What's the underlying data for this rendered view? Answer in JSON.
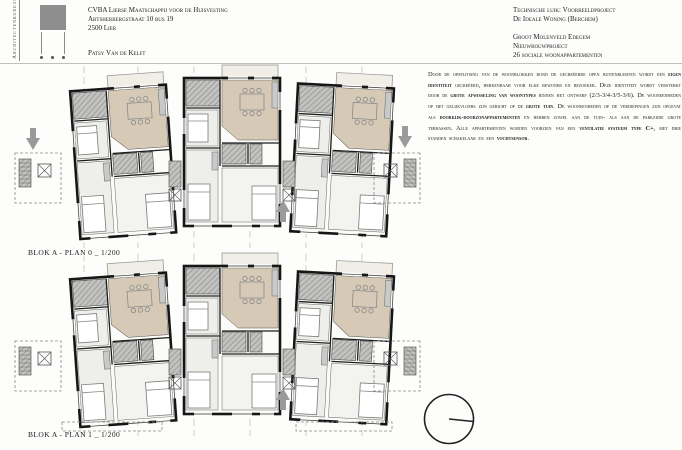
{
  "header": {
    "studio_vertical_label": "Architectenbureau",
    "client": {
      "line1": "CVBA Lierse Maatschappij voor de Huisvesting",
      "line2": "Abtsherbergstraat 10 bus 19",
      "line3": "2500 Lier",
      "contact": "Patsy Van de Kelft"
    },
    "project": {
      "line1": "Technische luik: Voorbeeldproject",
      "line2": "De Ideale Woning (Berchem)",
      "line3": "Groot Molenveld Edegem",
      "line4": "Nieuwbouwproject",
      "line5": "26 sociale woonappartementen"
    }
  },
  "description": {
    "segments": [
      {
        "t": "Door de opsplitsing van de woonblokken rond de gecreëerde open buitenruimten wordt een ",
        "b": false
      },
      {
        "t": "eigen identiteit",
        "b": true
      },
      {
        "t": " gecreëerd, herkenbaar voor elke bewoner en bezoeker. Deze identiteit wordt versterkt door de ",
        "b": false
      },
      {
        "t": "grote afwisseling van woontypes",
        "b": true
      },
      {
        "t": " binnen het ontwerp (2/3-3/4-3/5-3/6). De wooneenheden op het gelijkvloers zijn gericht op de ",
        "b": false
      },
      {
        "t": "grote tuin",
        "b": true
      },
      {
        "t": ". De wooneenheden op de verdiepingen zijn opgevat als ",
        "b": false
      },
      {
        "t": "doorkijk-doorzonappartementen",
        "b": true
      },
      {
        "t": " en hebben zowel aan de tuin- als aan de parkzijde grote terrassen. Alle appartementen worden voorzien van een ",
        "b": false
      },
      {
        "t": "ventilatie systeem type C+",
        "b": true
      },
      {
        "t": ", met drie standen schakelaar en een ",
        "b": false
      },
      {
        "t": "vochtsensor",
        "b": true
      },
      {
        "t": ".",
        "b": false
      }
    ]
  },
  "plans": [
    {
      "label": "BLOK A - PLAN 0 _ 1/200"
    },
    {
      "label": "BLOK A - PLAN 1 _ 1/200"
    }
  ],
  "colors": {
    "wall": "#161616",
    "beige": "#d6cab7",
    "hatch_gray": "#b5b5b3",
    "arrow_gray": "#9a9a9a",
    "line_gray": "#c0c0bd"
  }
}
